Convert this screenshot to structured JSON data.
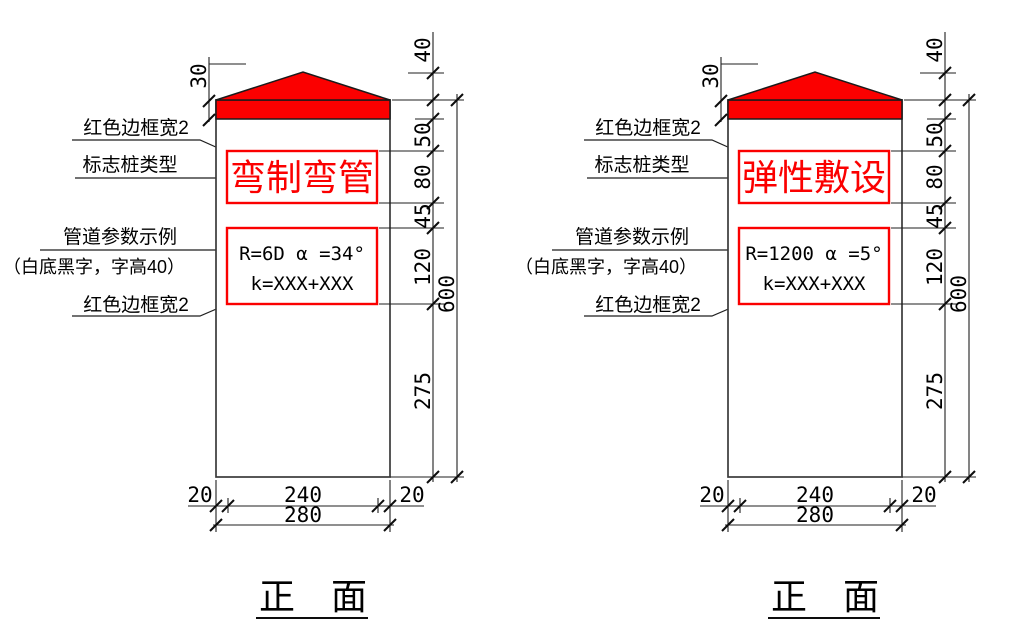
{
  "drawing": {
    "view_title": "正　面",
    "colors": {
      "red": "#fb0000",
      "line_black": "#1f1f1f"
    },
    "callouts": {
      "red_border_top": "红色边框宽2",
      "type_label": "标志桩类型",
      "param_label": "管道参数示例",
      "param_note": "（白底黑字，字高40）",
      "red_border_bottom": "红色边框宽2"
    },
    "dims": {
      "cap_height": "40",
      "band_height": "30",
      "band_to_typebox": "50",
      "typebox_height": "80",
      "between_boxes": "45",
      "parambox_height": "120",
      "below_boxes": "275",
      "post_height": "600",
      "left_margin": "20",
      "inner_width": "240",
      "right_margin": "20",
      "total_width": "280"
    },
    "posts": [
      {
        "type_text": "弯制弯管",
        "param_line1": "R=6D  α =34°",
        "param_line2": "k=XXX+XXX"
      },
      {
        "type_text": "弹性敷设",
        "param_line1": "R=1200  α =5°",
        "param_line2": "k=XXX+XXX"
      }
    ]
  }
}
